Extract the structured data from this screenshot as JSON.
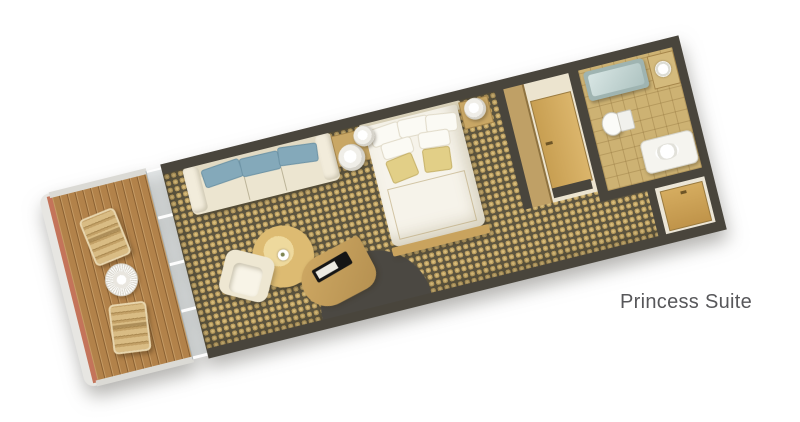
{
  "label": {
    "text": "Princess Suite"
  },
  "plan": {
    "type": "floorplan",
    "view": "top-down 3D render, rotated",
    "rooms": [
      {
        "name": "Balcony",
        "items": [
          "wood plank decking",
          "wicker lounge chair",
          "round lace table",
          "wicker lounge chair",
          "railing",
          "hull edge with red stripe"
        ]
      },
      {
        "name": "Living Area",
        "items": [
          "glass door wall",
          "cream sofa with three blue cushions",
          "lamp table with round lamp",
          "round coffee table with flower vase",
          "cream armchair",
          "curved TV cabinet with television",
          "dark curved alcove partition",
          "patterned gold carpet"
        ]
      },
      {
        "name": "Bedroom",
        "items": [
          "double bed with white duvet",
          "white pillows",
          "two gold accent pillows",
          "headboard",
          "wood footboard bench",
          "bedside lamp left",
          "bedside lamp right",
          "nightstand"
        ]
      },
      {
        "name": "Closet Nook",
        "items": [
          "wood wardrobe partition",
          "closet door with handle"
        ]
      },
      {
        "name": "Bathroom",
        "items": [
          "bathtub",
          "sink counter with round basin",
          "toilet",
          "vanity with basin",
          "tiled floor"
        ]
      },
      {
        "name": "Entry",
        "items": [
          "vestibule floor",
          "entry door with handle"
        ]
      }
    ],
    "colors": {
      "wall": "#49453c",
      "carpet_gold": "#bda061",
      "carpet_dark": "#5d553f",
      "deck_wood": "#b2824a",
      "hull_stripe": "#c4745a",
      "upholstery_cream": "#ece5d0",
      "cushion_blue": "#84a9ba",
      "pillow_gold": "#e2cf87",
      "door_wood": "#c89f52",
      "tub_aqua": "#aec3c1",
      "fixture_white": "#f5f4ef",
      "label_text": "#57575a",
      "background": "#ffffff"
    }
  }
}
